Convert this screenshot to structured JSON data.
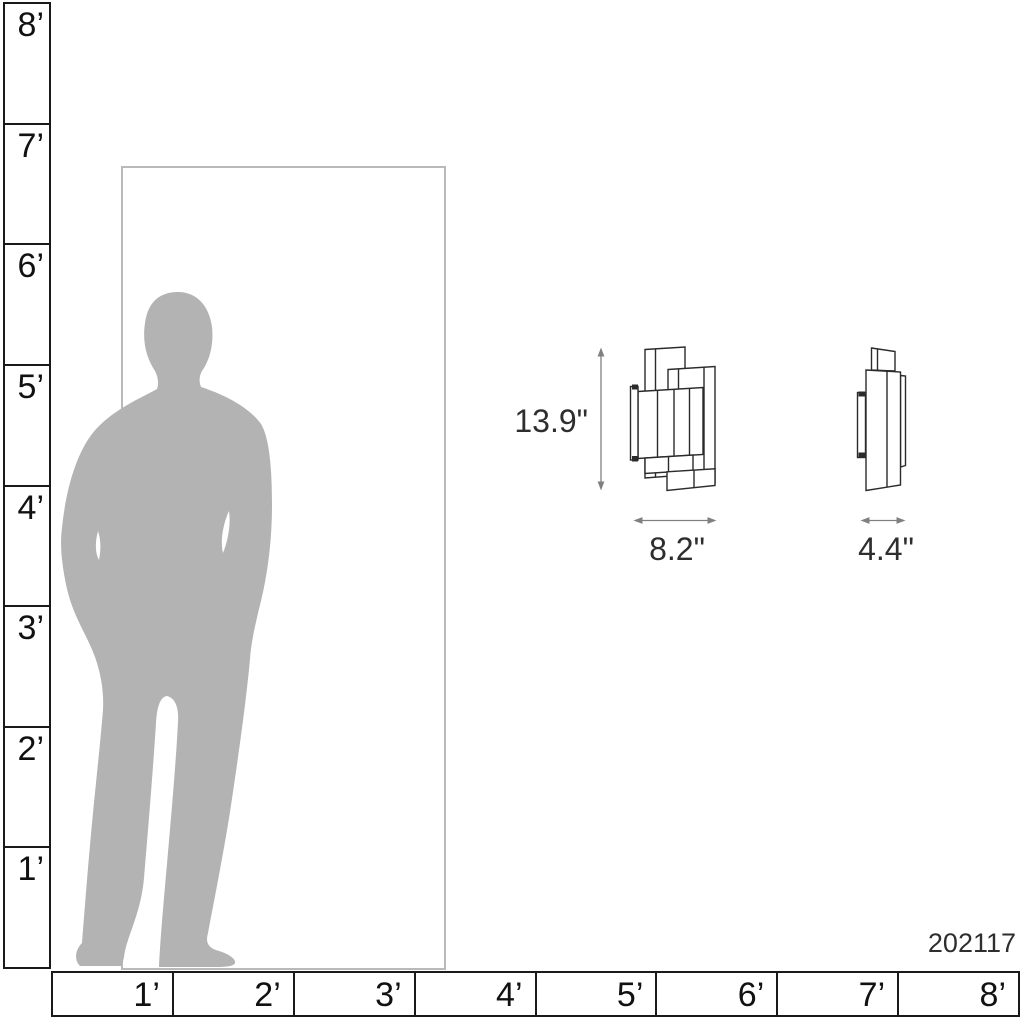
{
  "product": {
    "sku": "202117"
  },
  "dimensions": {
    "height": "13.9\"",
    "width": "8.2\"",
    "depth": "4.4\""
  },
  "left_ruler": {
    "unit": "feet",
    "labels": [
      "8’",
      "7’",
      "6’",
      "5’",
      "4’",
      "3’",
      "2’",
      "1’"
    ]
  },
  "bottom_ruler": {
    "unit": "feet",
    "labels": [
      "1’",
      "2’",
      "3’",
      "4’",
      "5’",
      "6’",
      "7’",
      "8’"
    ]
  },
  "colors": {
    "silhouette": "#b3b3b3",
    "door": "#b9b9b9",
    "ruler": "#1a1a1a",
    "line_art": "#2b2b2b",
    "arrow": "#808080",
    "text": "#2e2e2e"
  }
}
